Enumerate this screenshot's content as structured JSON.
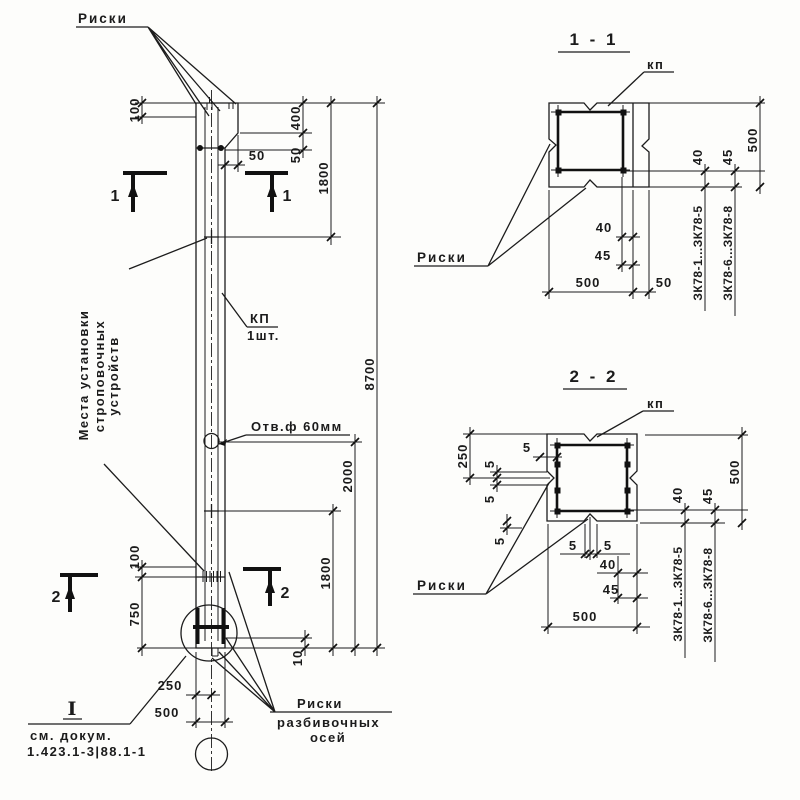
{
  "elevation": {
    "riski_top": "Риски",
    "mesta_line1": "Места установки",
    "mesta_line2": "строповочных",
    "mesta_line3": "устройств",
    "kp": "КП",
    "kp_qty": "1шт.",
    "hole": "Отв.ф 60мм",
    "detail_mark": "I",
    "see_doc_1": "см. докум.",
    "see_doc_2": "1.423.1-3|88.1-1",
    "riski_axes_1": "Риски",
    "riski_axes_2": "разбивочных",
    "riski_axes_3": "осей",
    "cut1": "1",
    "cut2": "2",
    "dims": {
      "top_mark_offset": "100",
      "step_height": "400",
      "step_v": "50",
      "step_h": "50",
      "strop_top": "1800",
      "total_height": "8700",
      "hole_from_bottom": "2000",
      "strop_bottom": "1800",
      "bottom_mark_offset": "100",
      "bottom_strop": "750",
      "bottom_axis": "10",
      "half_width": "250",
      "width": "500"
    }
  },
  "section_1_1": {
    "title": "1 - 1",
    "kp": "кп",
    "riski": "Риски",
    "marks_a": "ЗК78-1...ЗК78-5",
    "marks_b": "ЗК78-6...ЗК78-8",
    "dims": {
      "d40": "40",
      "d45": "45",
      "d500": "500",
      "d50": "50",
      "r40": "40",
      "r45": "45",
      "r500": "500"
    }
  },
  "section_2_2": {
    "title": "2 - 2",
    "kp": "кп",
    "riski": "Риски",
    "marks_a": "ЗК78-1...ЗК78-5",
    "marks_b": "ЗК78-6...ЗК78-8",
    "dims": {
      "d250": "250",
      "d5": "5",
      "d40": "40",
      "d45": "45",
      "d500": "500",
      "r40": "40",
      "r45": "45",
      "r500": "500"
    }
  }
}
